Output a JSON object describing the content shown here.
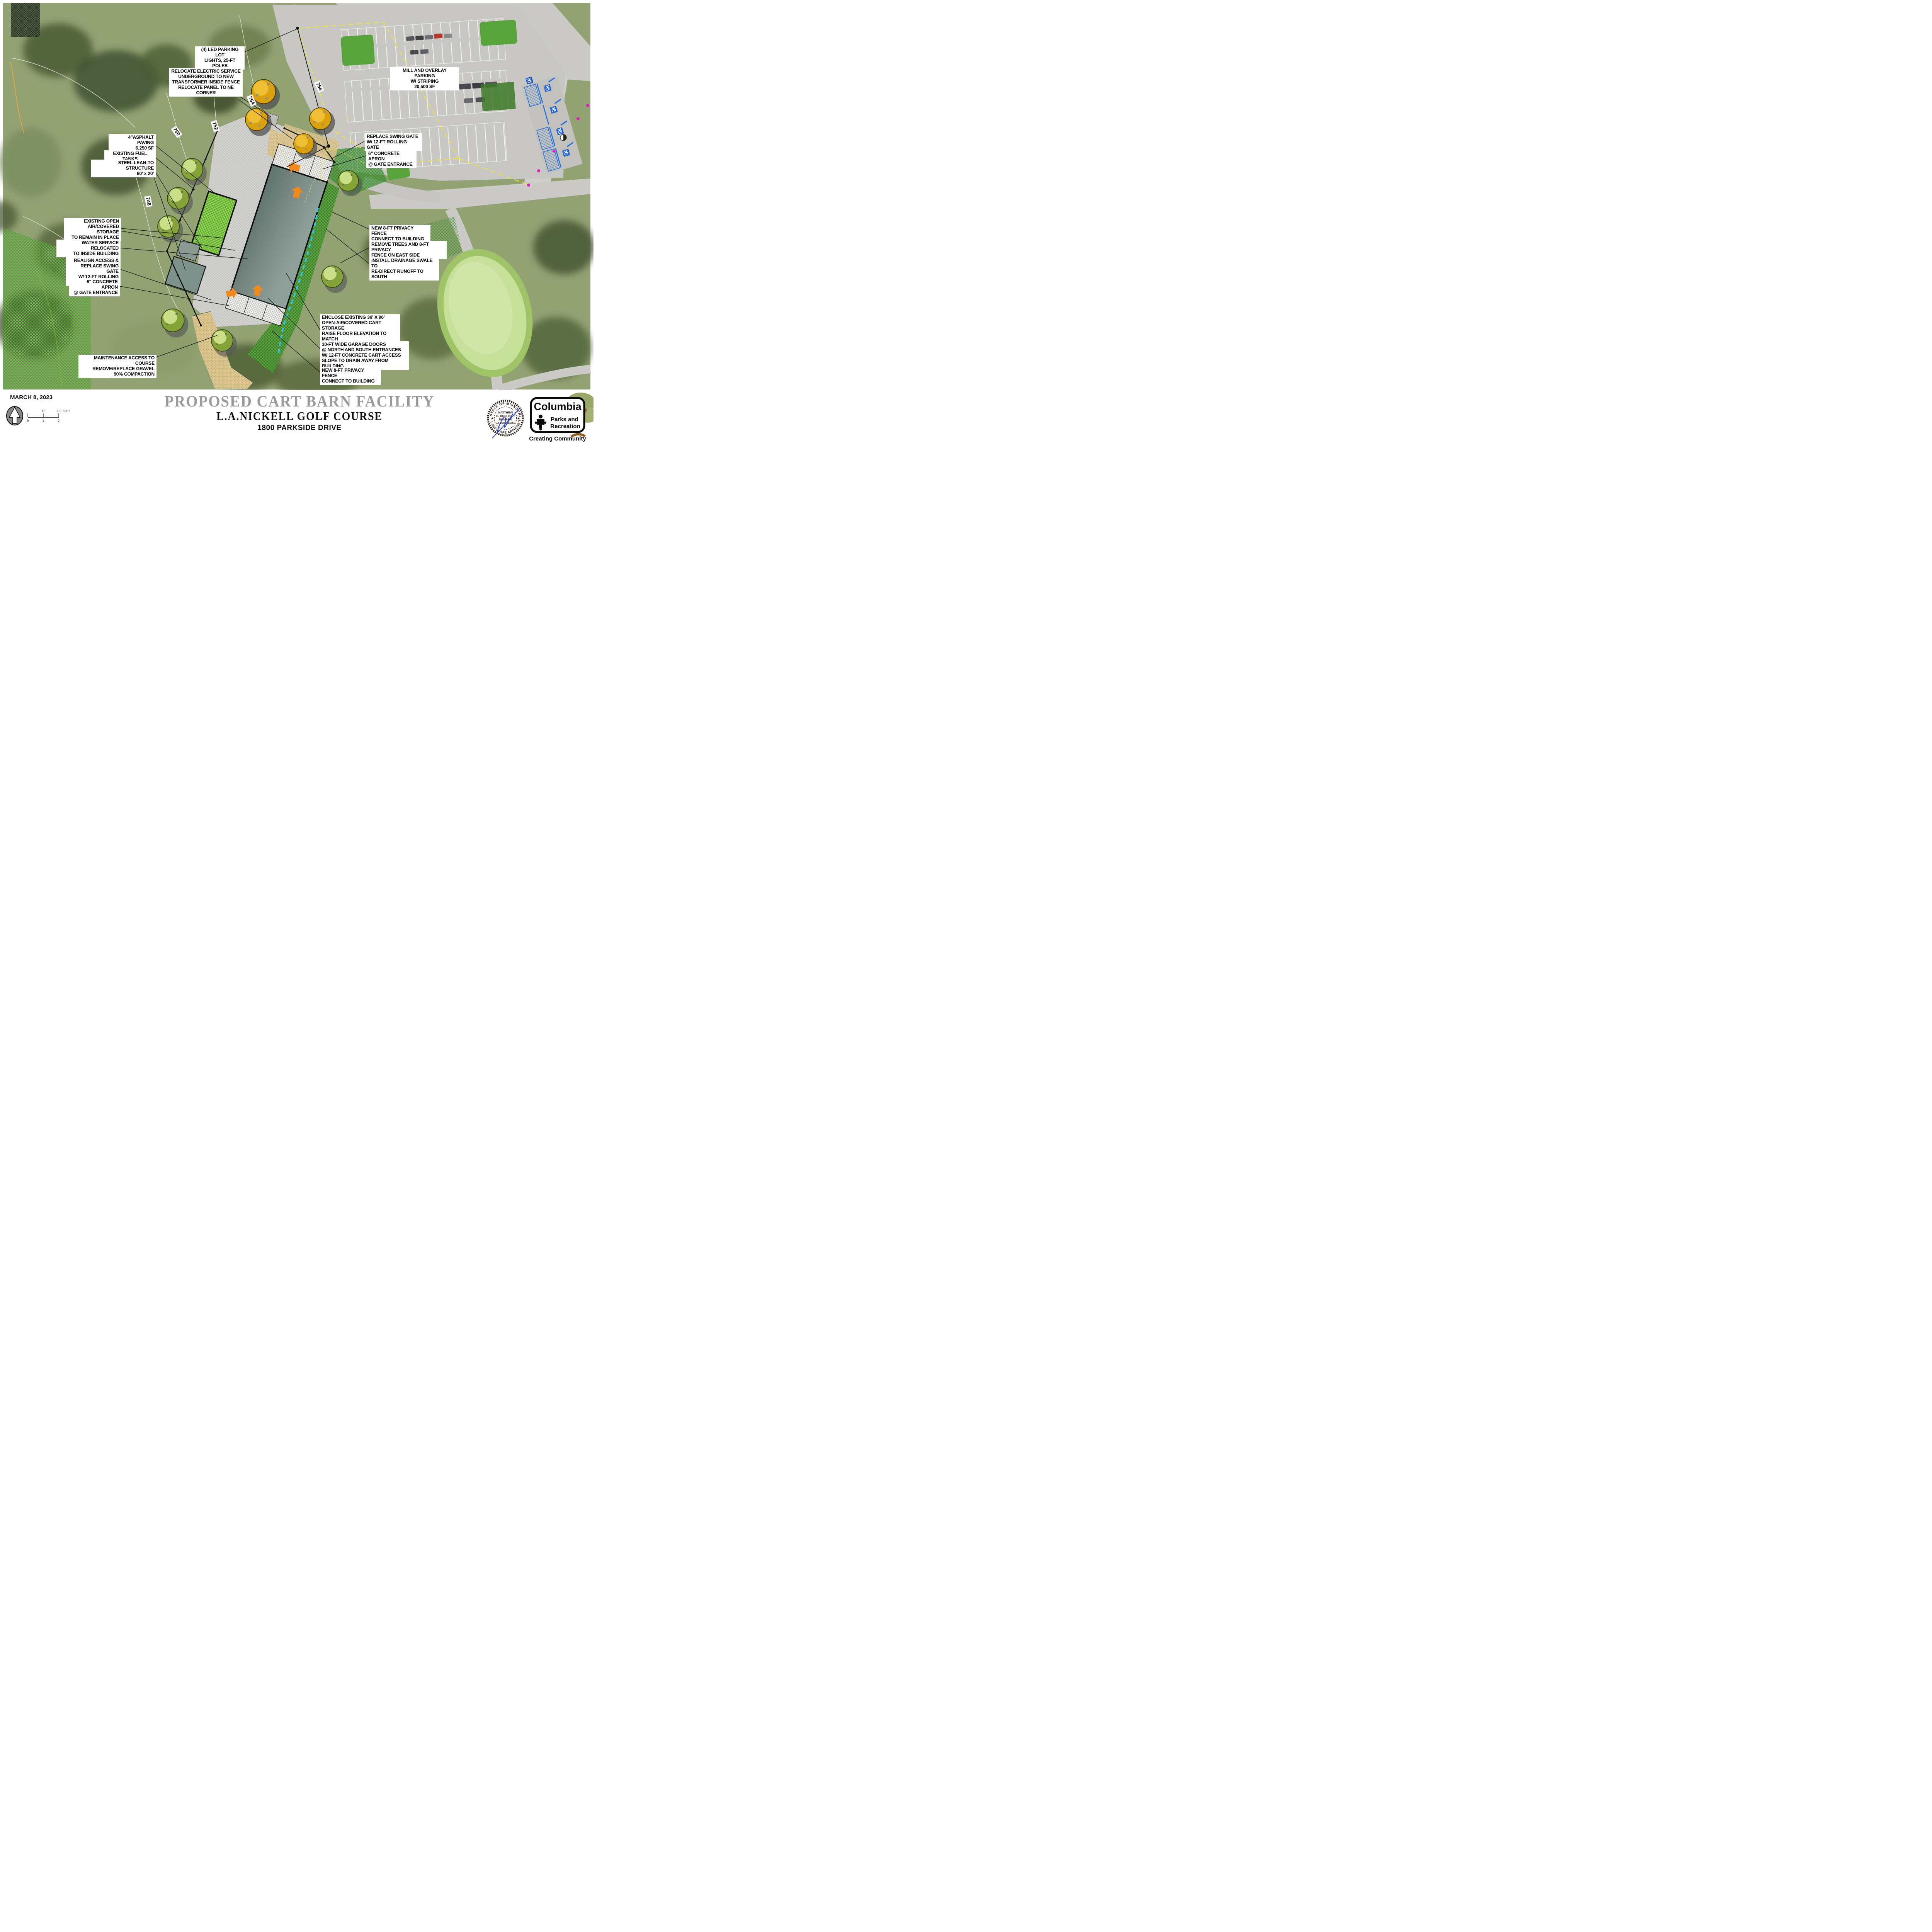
{
  "title_block": {
    "date": "MARCH 8, 2023",
    "title": "PROPOSED CART BARN FACILITY",
    "course": "L.A.NICKELL GOLF COURSE",
    "address": "1800 PARKSIDE DRIVE"
  },
  "scale_bar": {
    "ten": "10",
    "twenty": "20",
    "unit": "FEET",
    "zero": "0",
    "one": "1",
    "two": "2"
  },
  "map": {
    "contours": [
      "756",
      "754",
      "752",
      "750",
      "748"
    ],
    "callouts": [
      {
        "id": "led-lights",
        "text": "(4) LED PARKING LOT\nLIGHTS, 25-FT POLES"
      },
      {
        "id": "electric-service",
        "text": "RELOCATE ELECTRIC SERVICE\nUNDERGROUND TO NEW\nTRANSFORMER INSIDE FENCE\nRELOCATE PANEL TO NE CORNER"
      },
      {
        "id": "mill-overlay",
        "text": "MILL AND OVERLAY PARKING\nW/ STRIPING\n20,500 SF"
      },
      {
        "id": "asphalt-paving",
        "text": "4\"ASPHALT PAVING\n6,250 SF"
      },
      {
        "id": "fuel-tanks",
        "text": "EXISTING FUEL TANKS"
      },
      {
        "id": "lean-to",
        "text": "STEEL LEAN-TO STRUCTURE\n60' x 20'"
      },
      {
        "id": "swing-gate-north",
        "text": "REPLACE SWING GATE\nW/ 12-FT ROLLING GATE"
      },
      {
        "id": "apron-north",
        "text": "6\" CONCRETE APRON\n@ GATE ENTRANCE"
      },
      {
        "id": "open-air-storage",
        "text": "EXISTING OPEN\nAIR/COVERED  STORAGE\nTO REMAIN IN PLACE"
      },
      {
        "id": "water-service",
        "text": "WATER SERVICE RELOCATED\nTO INSIDE BUILDING"
      },
      {
        "id": "realign-access",
        "text": "REALIGN ACCESS &\nREPLACE SWING GATE\nW/ 12-FT ROLLING GATE"
      },
      {
        "id": "apron-south",
        "text": "6\" CONCRETE APRON\n@ GATE ENTRANCE"
      },
      {
        "id": "privacy-fence-ne",
        "text": "NEW 8-FT PRIVACY FENCE\nCONNECT TO BUILDING"
      },
      {
        "id": "remove-trees",
        "text": "REMOVE TREES AND 8-FT PRIVACY\nFENCE ON EAST SIDE"
      },
      {
        "id": "drainage-swale",
        "text": "INSTALL DRAINAGE SWALE TO\nRE-DIRECT RUNOFF TO SOUTH"
      },
      {
        "id": "enclose-storage",
        "text": "ENCLOSE EXISTING 36' X 96'\nOPEN-AIR/COVERED CART STORAGE\nRAISE FLOOR ELEVATION TO MATCH\nNORTH ENTRANCE"
      },
      {
        "id": "garage-doors",
        "text": "10-FT WIDE GARAGE DOORS\n@ NORTH AND SOUTH ENTRANCES\nW/ 12-FT CONCRETE CART ACCESS\nSLOPE TO DRAIN AWAY FROM BUILDING"
      },
      {
        "id": "privacy-fence-south",
        "text": "NEW 8-FT PRIVACY FENCE\nCONNECT TO BUILDING"
      },
      {
        "id": "maintenance-access",
        "text": "MAINTENANCE ACCESS TO COURSE\nREMOVE/REPLACE GRAVEL\n90% COMPACTION"
      }
    ]
  },
  "logo": {
    "name": "Columbia",
    "dept1": "Parks and",
    "dept2": "Recreation",
    "tagline": "Creating Community"
  },
  "seal": {
    "arc_top": "STATE OF MISSOURI",
    "arc_bottom": "LANDSCAPE ARCHITECT",
    "line1": "MATTHEW",
    "line2": "B. BOEHNER",
    "line3": "NUMBER",
    "line4": "LA-2009014760"
  },
  "colors": {
    "callout_bg": "#ffffff",
    "swale_line": "#2fc7ea",
    "property_line": "#efe33a",
    "entrance_arrow": "#f2891d",
    "ada_blue": "#1d6fe0",
    "tree_gold": "#daa10f",
    "tree_green": "#84a338",
    "light_pole_dot": "#e020c0",
    "title_gray": "#9a9a9a"
  }
}
